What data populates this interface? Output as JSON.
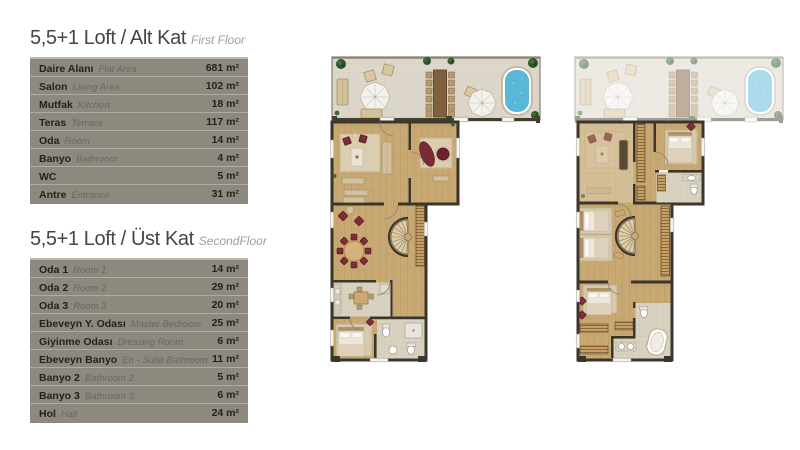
{
  "page": {
    "background": "#ffffff"
  },
  "colors": {
    "table_background": "#8e897f",
    "row_divider": "#b0aba0",
    "label_text": "#25221d",
    "label_text_en": "#6b675f",
    "title_text": "#454543",
    "subtitle_text": "#a09e99",
    "wood_floor": "#c8a873",
    "terrace_floor": "#ddd6ca",
    "light_floor": "#d9d2c0",
    "wall": "#3a362b",
    "pool_blue": "#5ab7d8",
    "furniture_maroon": "#7a2b36",
    "plant_green": "#2c5629"
  },
  "tables": [
    {
      "title_tr": "5,5+1 Loft / Alt Kat",
      "title_en": "First Floor",
      "rows": [
        {
          "tr": "Daire Alanı",
          "en": "Flat Area",
          "value": "681 m²"
        },
        {
          "tr": "Salon",
          "en": "Living Area",
          "value": "102 m²"
        },
        {
          "tr": "Mutfak",
          "en": "Kitchen",
          "value": "18 m²"
        },
        {
          "tr": "Teras",
          "en": "Terrace",
          "value": "117 m²"
        },
        {
          "tr": "Oda",
          "en": "Room",
          "value": "14 m²"
        },
        {
          "tr": "Banyo",
          "en": "Bathroom",
          "value": "4 m²"
        },
        {
          "tr": "WC",
          "en": "",
          "value": "5 m²"
        },
        {
          "tr": "Antre",
          "en": "Entrance",
          "value": "31 m²"
        }
      ]
    },
    {
      "title_tr": "5,5+1 Loft / Üst Kat",
      "title_en": "SecondFloor",
      "rows": [
        {
          "tr": "Oda 1",
          "en": "Room 1",
          "value": "14 m²"
        },
        {
          "tr": "Oda 2",
          "en": "Room 2",
          "value": "29 m²"
        },
        {
          "tr": "Oda 3",
          "en": "Room 3",
          "value": "20 m²"
        },
        {
          "tr": "Ebeveyn Y. Odası",
          "en": "Master Bedroom",
          "value": "25 m²"
        },
        {
          "tr": "Giyinme Odası",
          "en": "Dressing Room",
          "value": "6 m²"
        },
        {
          "tr": "Ebeveyn Banyo",
          "en": "En - Suite Bathroom",
          "value": "11 m²"
        },
        {
          "tr": "Banyo 2",
          "en": "Bathroom 2",
          "value": "5 m²"
        },
        {
          "tr": "Banyo 3",
          "en": "Bathroom 3",
          "value": "6 m²"
        },
        {
          "tr": "Hol",
          "en": "Hall",
          "value": "24 m²"
        }
      ]
    }
  ],
  "plans": [
    {
      "name": "first-floor-plan"
    },
    {
      "name": "second-floor-plan"
    }
  ]
}
